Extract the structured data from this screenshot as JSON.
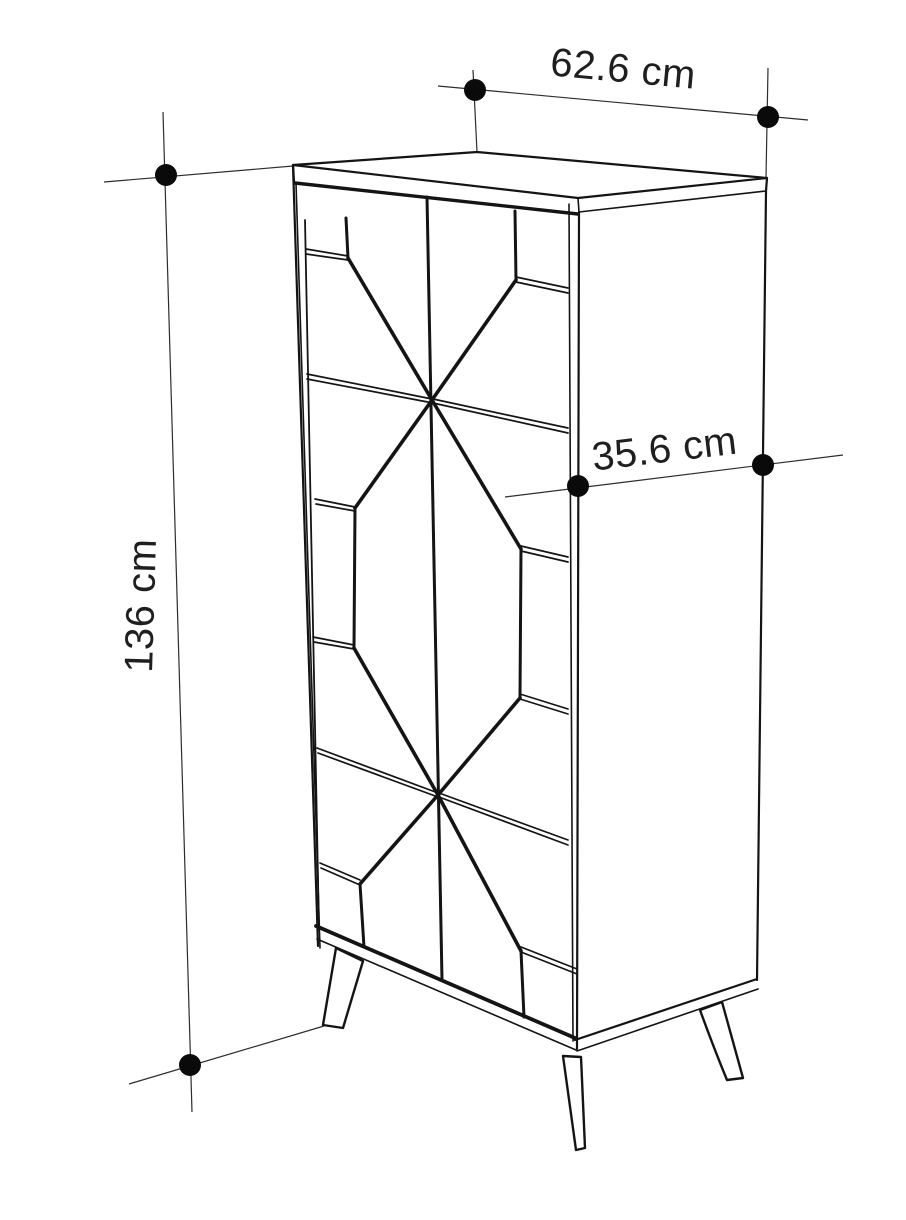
{
  "canvas": {
    "width": 906,
    "height": 1220,
    "background_color": "#ffffff",
    "line_color": "#141414",
    "extension_line_color": "#2d2d2d",
    "dot_color": "#0a0a0a",
    "text_color": "#1f1f1f"
  },
  "dimensions": {
    "width": {
      "label": "62.6 cm",
      "value": 62.6,
      "unit": "cm",
      "placement": "top"
    },
    "depth": {
      "label": "35.6 cm",
      "value": 35.6,
      "unit": "cm",
      "placement": "right-middle"
    },
    "height": {
      "label": "136 cm",
      "value": 136,
      "unit": "cm",
      "placement": "left-vertical"
    }
  }
}
